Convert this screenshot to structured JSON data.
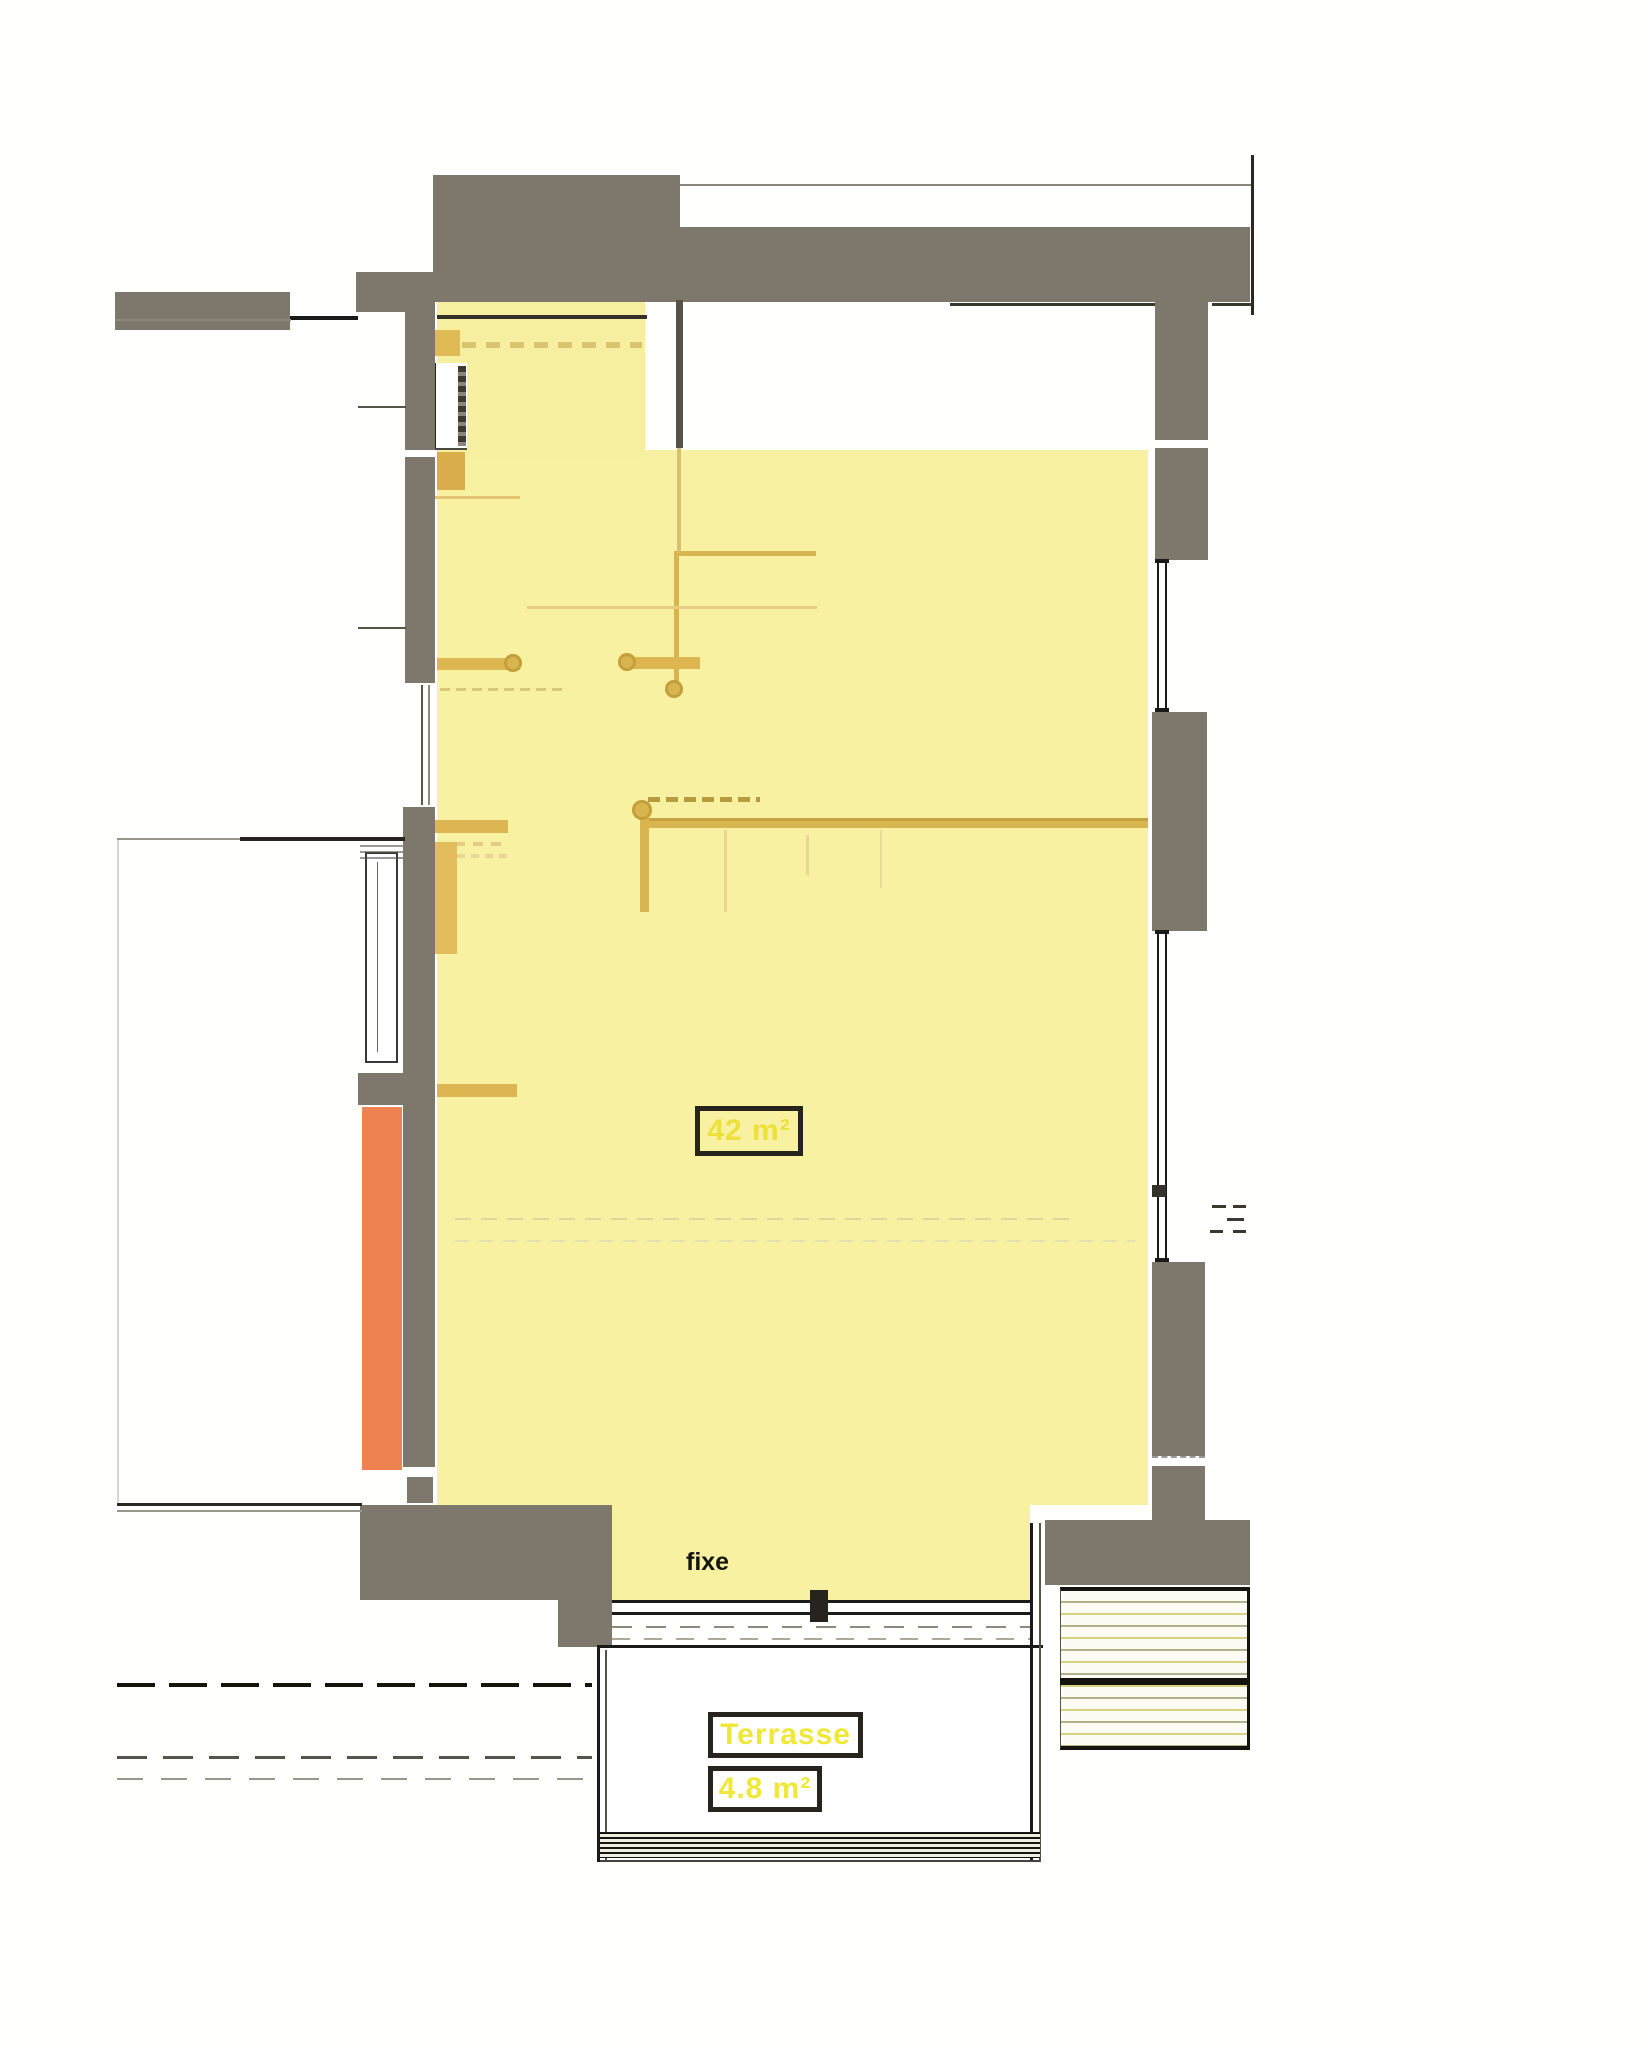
{
  "plan": {
    "type": "apartment-floor-plan-scan",
    "labels": {
      "main_area": "42 m²",
      "window_note": "fixe",
      "terrace_name": "Terrasse",
      "terrace_area": "4.8 m²"
    },
    "colors": {
      "wall_gray": "#7e786c",
      "room_yellow": "#f7f1a1",
      "highlight_orange": "#ee8251",
      "furniture_mustard": "#d9b54f",
      "label_yellow": "#ece03a",
      "outline_black": "#1a1a1a"
    }
  }
}
